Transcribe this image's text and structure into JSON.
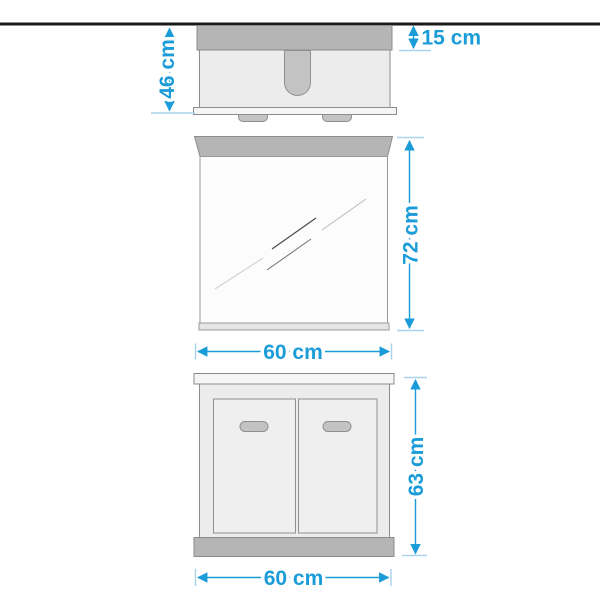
{
  "diagram": {
    "labels": {
      "top_view_depth": "46 cm",
      "top_view_overhang": "15 cm",
      "mirror_height": "72 cm",
      "mirror_width": "60 cm",
      "cabinet_height": "63 cm",
      "cabinet_width": "60 cm"
    },
    "colors": {
      "accent": "#1a9cd8",
      "tick": "#a9d3ea",
      "wall": "#1a1a1a",
      "panel-dark": "#b5b5b5",
      "panel-light": "#ececec",
      "outline": "#8c8c8c"
    },
    "unit": "cm"
  }
}
